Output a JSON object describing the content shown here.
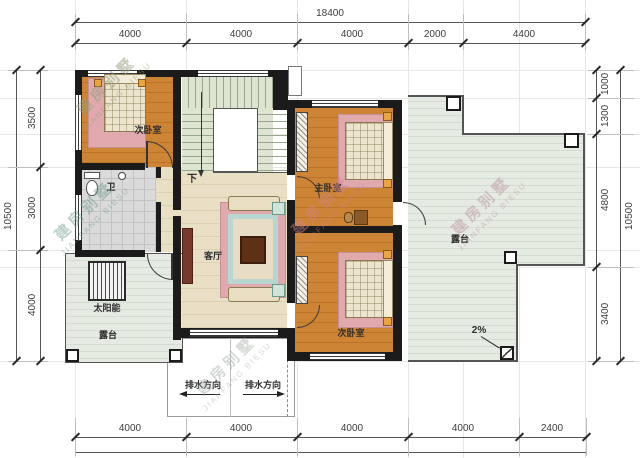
{
  "labels": {
    "bedroom_top_left": "次卧室",
    "bathroom": "卫",
    "stairs_down": "下",
    "living_room": "客厅",
    "master_bedroom": "主卧室",
    "bedroom_bottom_right": "次卧室",
    "terrace_right": "露台",
    "terrace_left": "露台",
    "solar_water_heater": "太阳能",
    "drain_direction_left": "排水方向",
    "drain_direction_right": "排水方向",
    "roof_slope": "2%"
  },
  "dims": {
    "top": {
      "total": "18400",
      "segments": [
        "4000",
        "4000",
        "4000",
        "2000",
        "4400"
      ]
    },
    "bottom": {
      "segments": [
        "4000",
        "4000",
        "4000",
        "4000",
        "2400"
      ]
    },
    "left": {
      "total": "10500",
      "segments": [
        "3500",
        "3000",
        "4000"
      ]
    },
    "right": {
      "total": "10500",
      "segments": [
        "1000",
        "1300",
        "4800",
        "3400"
      ]
    }
  },
  "watermark": {
    "cn": "建房别墅",
    "en": "JIANFANG BIESU"
  },
  "colors": {
    "wall": "#1b1b1b",
    "wood_floor": "#cd8434",
    "living_floor": "#e8dfc4",
    "terrace_tile": "#e5eae2",
    "stair_tread": "#dde4d0",
    "rug_pink": "#dfa9ae",
    "sofa_teal": "#c2ded7"
  }
}
